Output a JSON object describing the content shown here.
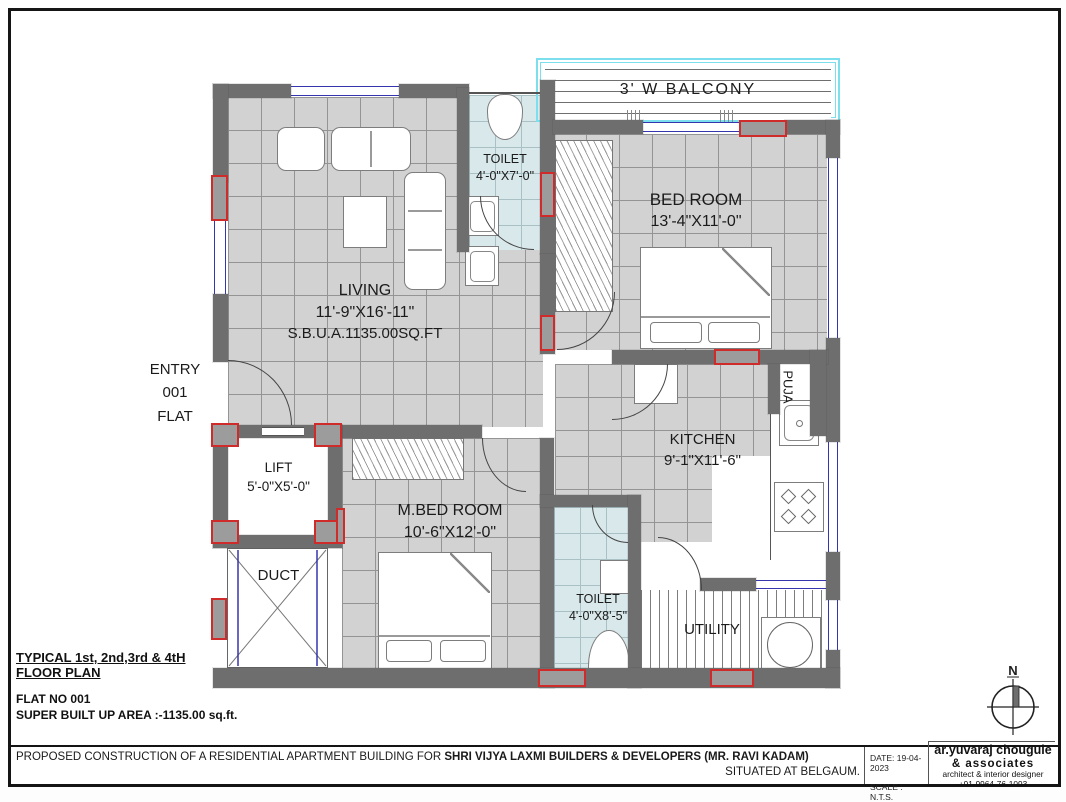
{
  "rooms": {
    "balcony": {
      "label": "3' W BALCONY"
    },
    "toilet_top": {
      "label": "TOILET",
      "size": "4'-0\"X7'-0\""
    },
    "bedroom": {
      "label": "BED ROOM",
      "size": "13'-4\"X11'-0\""
    },
    "living": {
      "label": "LIVING",
      "size": "11'-9\"X16'-11\"",
      "sbua": "S.B.U.A.1135.00SQ.FT"
    },
    "entry": {
      "line1": "ENTRY",
      "line2": "001",
      "line3": "FLAT"
    },
    "lift": {
      "label": "LIFT",
      "size": "5'-0\"X5'-0\""
    },
    "duct": {
      "label": "DUCT"
    },
    "master_bedroom": {
      "label": "M.BED ROOM",
      "size": "10'-6\"X12'-0\""
    },
    "kitchen": {
      "label": "KITCHEN",
      "size": "9'-1\"X11'-6\""
    },
    "puja": {
      "label": "PUJA"
    },
    "toilet_bottom": {
      "label": "TOILET",
      "size": "4'-0\"X8'-5\""
    },
    "utility": {
      "label": "UTILITY"
    }
  },
  "title_block": {
    "typical_line1": "TYPICAL 1st, 2nd,3rd & 4tH",
    "typical_line2": "FLOOR PLAN",
    "flat_no": "FLAT NO 001",
    "super_area": "SUPER BUILT UP AREA :-1135.00 sq.ft."
  },
  "footer": {
    "proposal_prefix": "PROPOSED CONSTRUCTION  OF A RESIDENTIAL APARTMENT  BUILDING FOR ",
    "proposal_bold": "SHRI VIJYA LAXMI BUILDERS & DEVELOPERS (MR. RAVI KADAM)",
    "situated": "SITUATED AT BELGAUM.",
    "date": "DATE: 19-04-2023",
    "scale": "SCALE : N.T.S.",
    "architect_line1": "ar.yuvaraj chougule",
    "architect_line2": "& associates",
    "architect_line3": "architect & interior designer",
    "architect_line4": "+91-9964-76-1093"
  },
  "north": {
    "label": "N"
  },
  "colors": {
    "wall": "#6e6e6e",
    "tile_floor": "#d2d2d2",
    "toilet_floor": "#d9e8eb",
    "column_outline": "#cf2b2b",
    "balcony_border": "#7bdfee",
    "window_line": "#3535ae"
  }
}
